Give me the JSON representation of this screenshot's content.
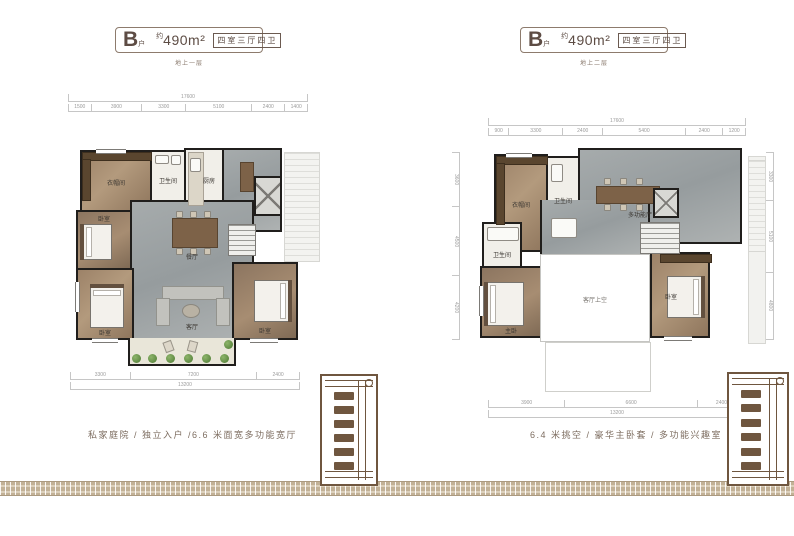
{
  "colors": {
    "accent_brown": "#6f563f",
    "badge_border": "#8d7b6d",
    "badge_text": "#5d4c44",
    "wall": "#201e1c",
    "gray_floor": "#9ea4a5",
    "wood_floor": "#a18967",
    "band_tan": "#c2b196",
    "dim_gray": "#9b9b9b"
  },
  "panels": [
    {
      "header": {
        "type_letter": "B",
        "type_suffix": "户",
        "area_prefix": "约",
        "area": "490m²",
        "layout": "四室三厅四卫"
      },
      "floor_caption": "地上一层",
      "feature_caption": "私家庭院 / 独立入户 /6.6 米面宽多功能宽厅",
      "rooms": {
        "closet": "衣帽间",
        "bath1": "卫生间",
        "kitchen": "厨房",
        "bedroom_mid": "卧室",
        "bedroom_bl": "卧室",
        "bedroom_br": "卧室",
        "dining": "餐厅",
        "living": "客厅",
        "garden": "庭院"
      },
      "dims": {
        "top_total": "17600",
        "top_segments": [
          "1500",
          "3900",
          "3300",
          "5100",
          "2400",
          "1400"
        ],
        "bottom_segments": [
          "3300",
          "7200",
          "2400"
        ],
        "bottom_total": "13200"
      }
    },
    {
      "header": {
        "type_letter": "B",
        "type_suffix": "户",
        "area_prefix": "约",
        "area": "490m²",
        "layout": "四室三厅四卫"
      },
      "floor_caption": "地上二层",
      "feature_caption": "6.4 米挑空 / 豪华主卧套 / 多功能兴趣室",
      "rooms": {
        "closet": "衣帽间",
        "bath1": "卫生间",
        "bath2": "卫生间",
        "hobby": "多功能厅",
        "master": "主卧",
        "bedroom": "卧室",
        "void_label": "客厅上空"
      },
      "dims": {
        "top_total": "17600",
        "top_segments": [
          "900",
          "3300",
          "2400",
          "5400",
          "2400",
          "1200"
        ],
        "bottom_segments": [
          "3900",
          "6600",
          "2400"
        ],
        "bottom_total": "13200",
        "left_segments": [
          "3600",
          "4500",
          "4200"
        ],
        "right_segments": [
          "3300",
          "5100",
          "4800"
        ]
      }
    }
  ]
}
